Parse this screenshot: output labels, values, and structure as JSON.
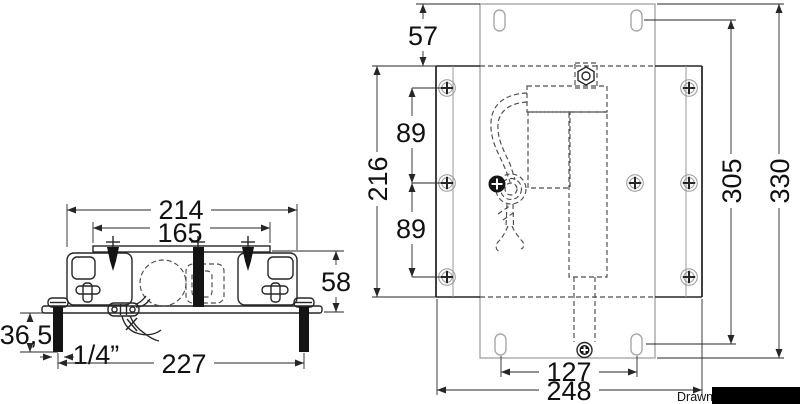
{
  "drawing": {
    "type": "technical-dimension-drawing",
    "colors": {
      "line_dark": "#262626",
      "line_light": "#a8a8a8",
      "dashed": "#4d4d4d",
      "background": "#ffffff",
      "redaction": "#000000"
    },
    "side_view": {
      "dims": {
        "overall_width": "214",
        "top_plate_width": "165",
        "profile_height": "58",
        "bolt_protrusion": "36,5",
        "bolt_diameter": "1/4”",
        "bolt_spacing": "227"
      }
    },
    "top_view": {
      "dims": {
        "plate_top_offset": "57",
        "rail_length": "216",
        "hole_pitch_top": "89",
        "hole_pitch_bottom": "89",
        "slot_span_vertical": "305",
        "plate_length": "330",
        "slot_span_horizontal": "127",
        "base_plate_width": "248"
      }
    },
    "footer": {
      "credit": "Drawn fro"
    }
  }
}
